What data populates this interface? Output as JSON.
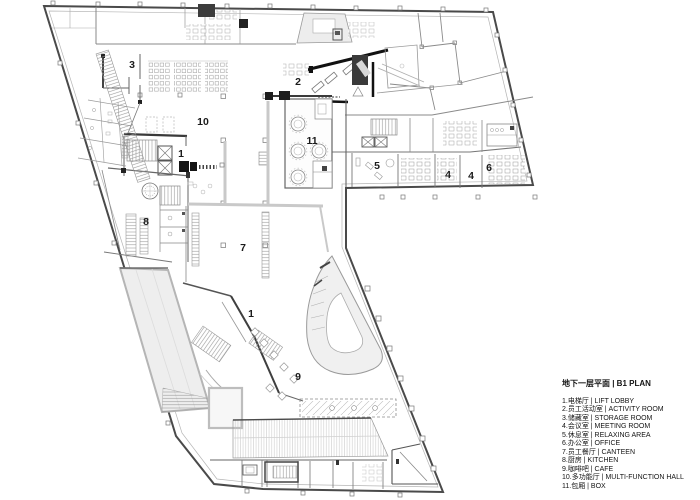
{
  "plan": {
    "name": "B1 floor plan drawing",
    "room_labels": [
      {
        "num": "3",
        "x": 132,
        "y": 65
      },
      {
        "num": "10",
        "x": 203,
        "y": 122
      },
      {
        "num": "1",
        "x": 181,
        "y": 154
      },
      {
        "num": "2",
        "x": 298,
        "y": 82
      },
      {
        "num": "11",
        "x": 312,
        "y": 141
      },
      {
        "num": "5",
        "x": 377,
        "y": 166
      },
      {
        "num": "4",
        "x": 448,
        "y": 175
      },
      {
        "num": "4",
        "x": 471,
        "y": 176
      },
      {
        "num": "6",
        "x": 489,
        "y": 168
      },
      {
        "num": "8",
        "x": 146,
        "y": 222
      },
      {
        "num": "7",
        "x": 243,
        "y": 248
      },
      {
        "num": "1",
        "x": 251,
        "y": 314
      },
      {
        "num": "9",
        "x": 298,
        "y": 377
      }
    ]
  },
  "legend": {
    "title": "地下一层平面 | B1 PLAN",
    "items": [
      "1.电梯厅 | LIFT LOBBY",
      "2.员工活动室 | ACTIVITY ROOM",
      "3.储藏室 | STORAGE ROOM",
      "4.会议室 | MEETING ROOM",
      "5.休息室 | RELAXING AREA",
      "6.办公室 | OFFICE",
      "7.员工餐厅 | CANTEEN",
      "8.厨房 | KITCHEN",
      "9.咖啡吧 | CAFE",
      "10.多功能厅 | MULTI-FUNCTION HALL",
      "11.包厢 | BOX"
    ]
  },
  "colors": {
    "outline": "#4a4a4a",
    "wall": "#777777",
    "wall_light": "#9a9a9a",
    "accent_black": "#111111",
    "gray_band": "#c9c9c9",
    "fill_light": "#efefef",
    "text": "#141414"
  }
}
